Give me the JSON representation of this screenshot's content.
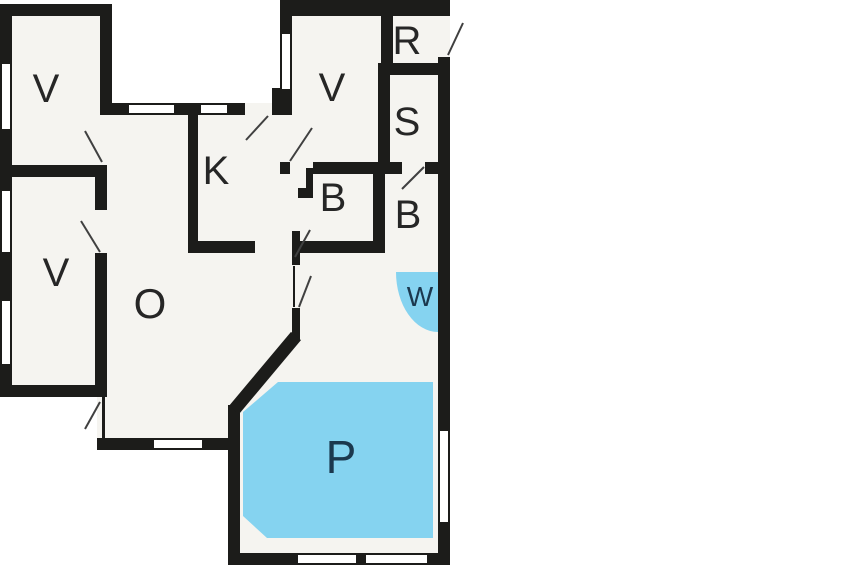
{
  "floorplan": {
    "title": "Holiday home floor plan",
    "rooms": [
      {
        "key": "bedroom-top-left",
        "label": "V"
      },
      {
        "key": "bedroom-left",
        "label": "V"
      },
      {
        "key": "bedroom-top-middle",
        "label": "V"
      },
      {
        "key": "storage-room",
        "label": "R"
      },
      {
        "key": "sauna",
        "label": "S"
      },
      {
        "key": "bathroom-left",
        "label": "B"
      },
      {
        "key": "bathroom-right",
        "label": "B"
      },
      {
        "key": "kitchen",
        "label": "K"
      },
      {
        "key": "living-room",
        "label": "O"
      },
      {
        "key": "whirlpool",
        "label": "W"
      },
      {
        "key": "pool",
        "label": "P"
      }
    ],
    "colors": {
      "wall": "#1c1c1a",
      "floor": "#f5f4f0",
      "outside": "#ffffff",
      "water": "#85d3f0",
      "water_label": "#1b384e",
      "room_label": "#262626"
    }
  }
}
